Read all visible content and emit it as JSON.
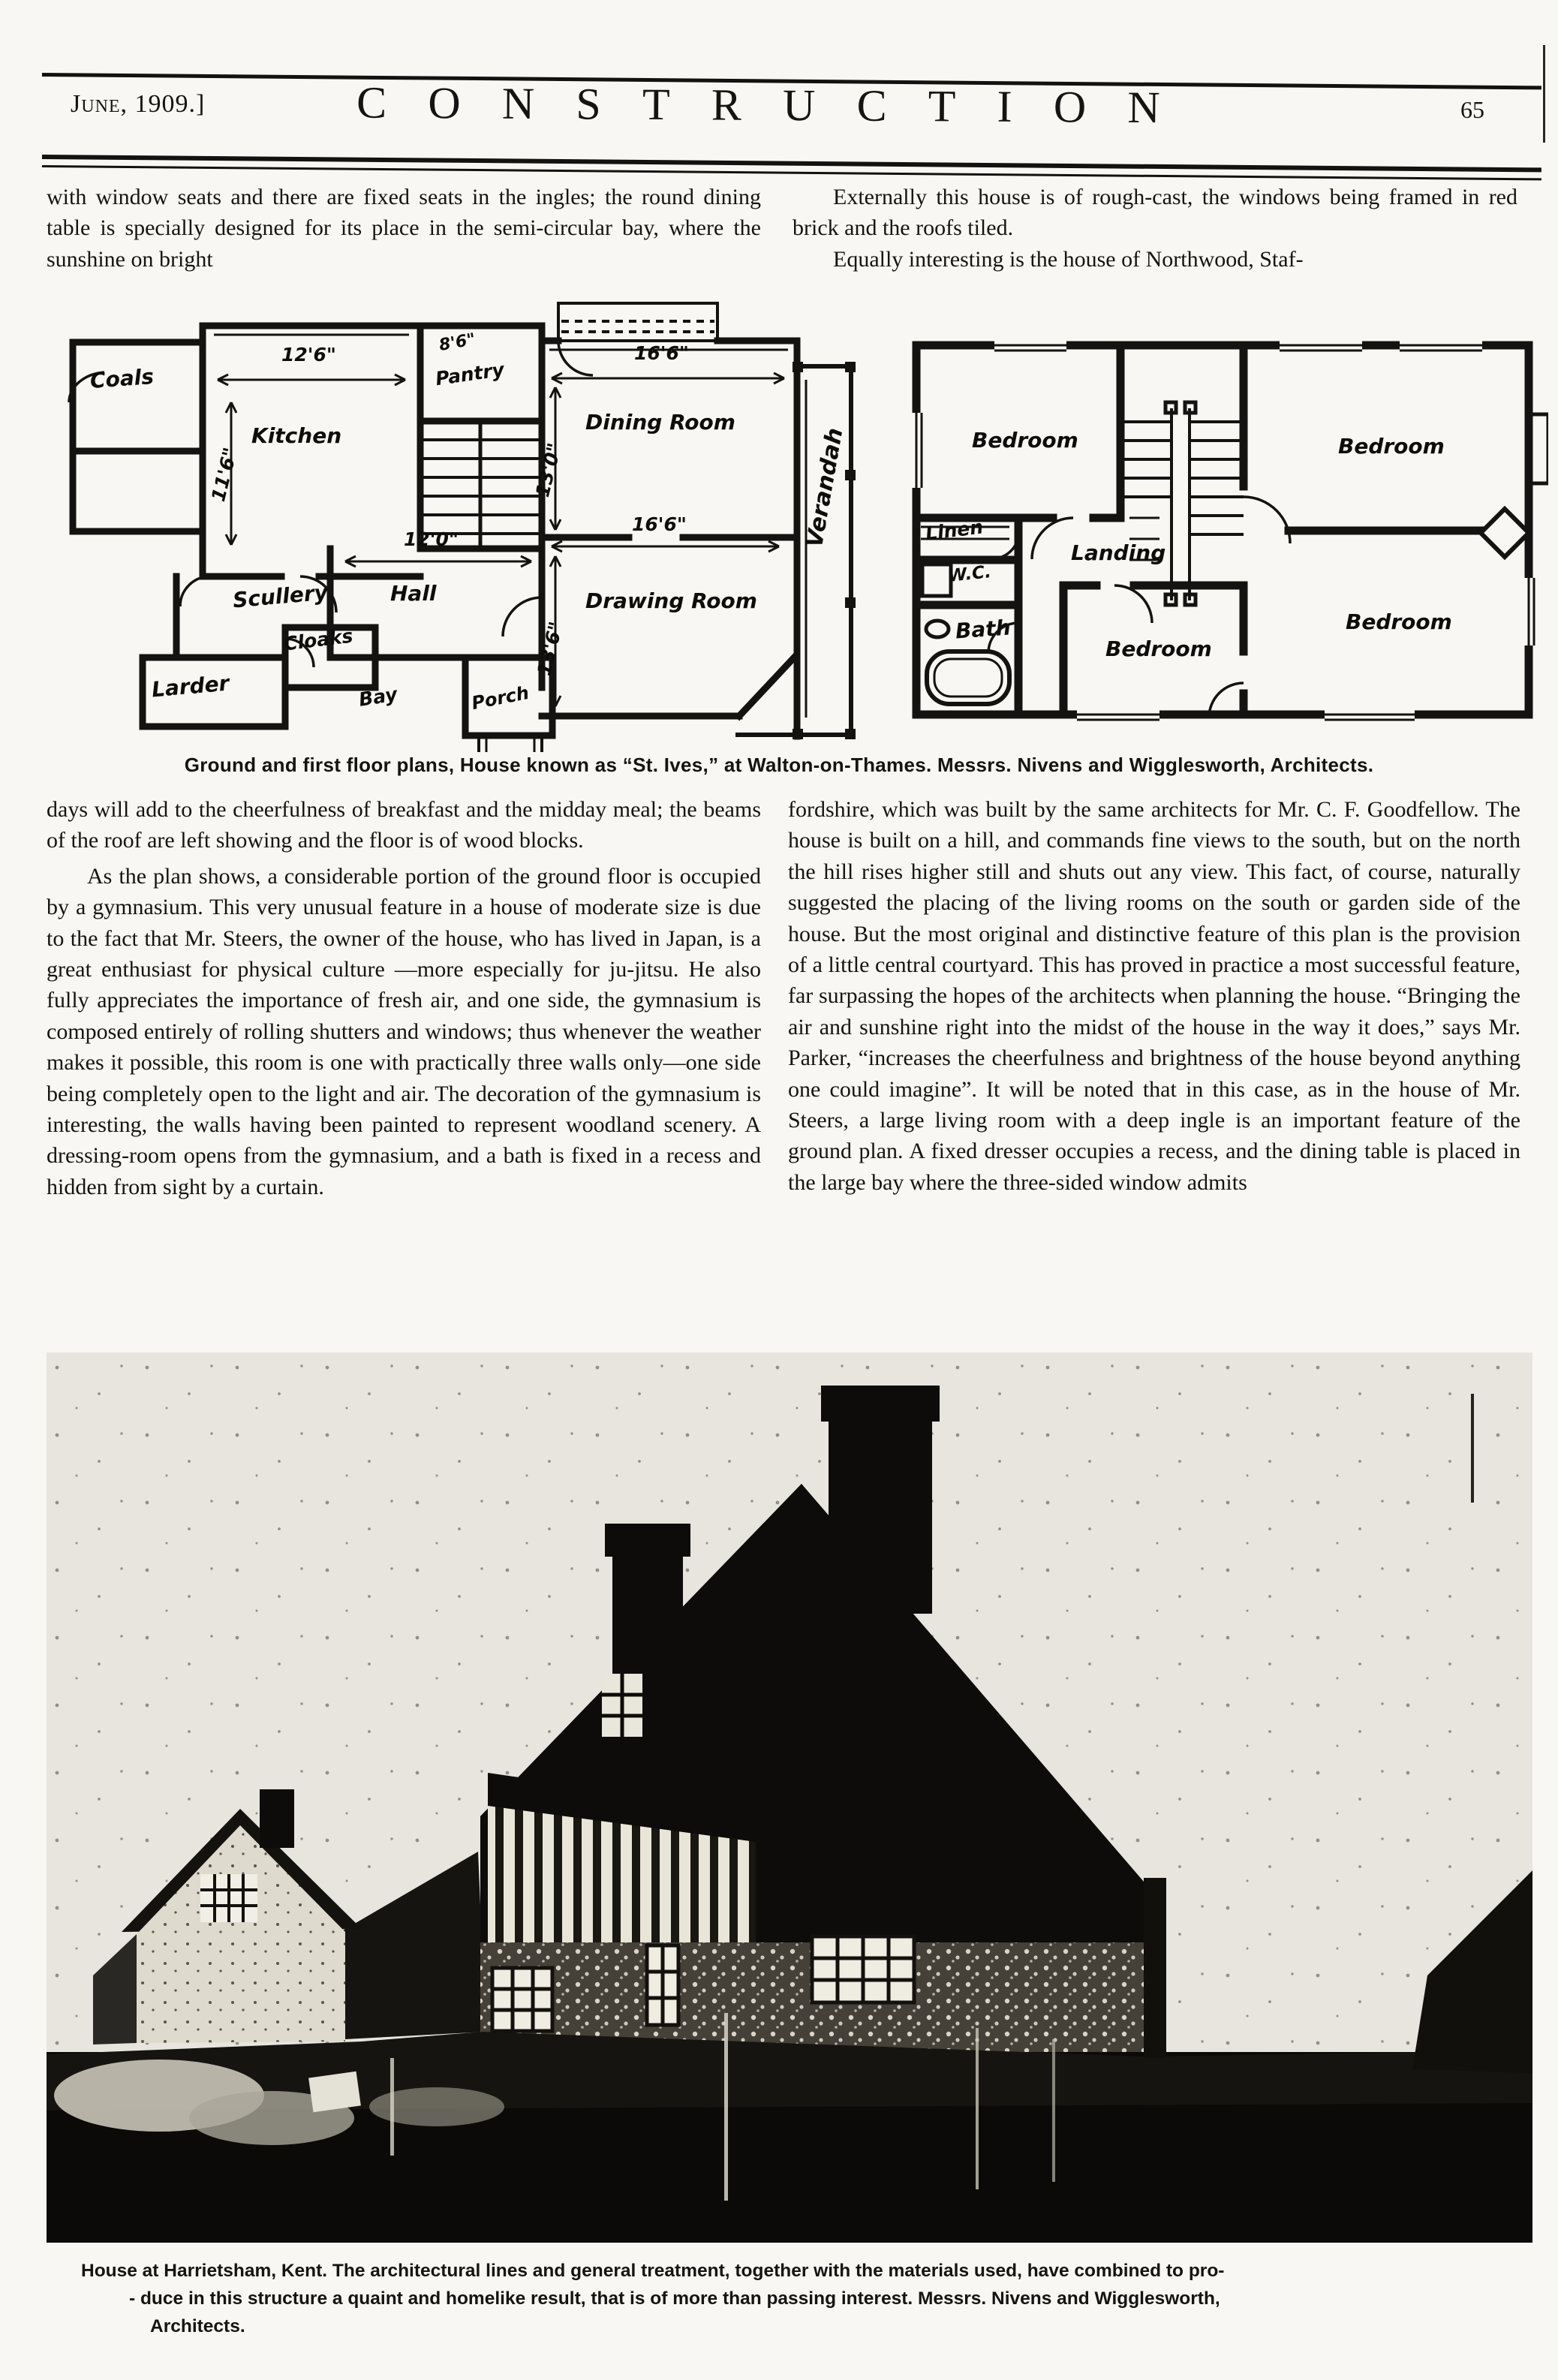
{
  "colors": {
    "ink": "#141413",
    "paper": "#f8f7f3",
    "photo_sky": "#e6e4dd",
    "photo_dark": "#0d0c0a"
  },
  "masthead": {
    "date": "June, 1909.]",
    "title": "CONSTRUCTION",
    "page_number": "65"
  },
  "intro": {
    "left": "with window seats and there are fixed seats in the ingles; the round dining table is specially designed for its place in the semi-circular bay, where the sunshine on bright",
    "right_para1": "Externally this house is of rough-cast, the windows being framed in red brick and the roofs tiled.",
    "right_para2": "Equally interesting is the house of Northwood, Staf-"
  },
  "plans": {
    "caption": "Ground and first floor plans, House known as “St. Ives,” at Walton-on-Thames.  Messrs. Nivens and Wigglesworth, Architects.",
    "ground": {
      "room_labels": [
        "Coals",
        "Kitchen",
        "Pantry",
        "Scullery",
        "Hall",
        "Larder",
        "Cloaks",
        "Bay",
        "Porch",
        "Dining Room",
        "Drawing Room",
        "Verandah"
      ],
      "dim_labels": [
        "12'6\"",
        "11'6\"",
        "8'6\"",
        "16'6\"",
        "13'0\"",
        "12'0\"",
        "16'6\"",
        "13'6\""
      ]
    },
    "first": {
      "room_labels": [
        "Bedroom",
        "Bedroom",
        "Linen",
        "Landing",
        "W.C.",
        "Bath",
        "Bedroom",
        "Bedroom"
      ]
    }
  },
  "article": {
    "left_para1": "days will add to the cheerfulness of breakfast and the midday meal; the beams of the roof are left showing and the floor is of wood blocks.",
    "left_para2": "As the plan shows, a considerable portion of the ground floor is occupied by a gymnasium.  This very unusual feature in a house of moderate size is due to the fact that Mr. Steers, the owner of the house, who has lived in Japan, is a great enthusiast for physical culture —more especially for ju-jitsu.  He also fully appreciates the importance of fresh air, and one side, the gymnasium is composed entirely of rolling shutters and windows; thus whenever the weather makes it possible, this room is one with practically three walls only—one side being completely open to the light and air.  The decoration of the gymnasium is interesting, the walls having been painted to represent woodland scenery.  A dressing-room opens from the gymnasium, and a bath is fixed in a recess and hidden from sight by a curtain.",
    "right_para1": "fordshire, which was built by the same architects for Mr. C. F. Goodfellow.  The house is built on a hill, and commands fine views to the south, but on the north the hill rises higher still and shuts out any view.  This fact, of course, naturally suggested the placing of the living rooms on the south or garden side of the house.  But the most original and distinctive feature of this plan is the provision of a little central courtyard.  This has proved in practice a most successful feature, far surpassing the hopes of the architects when planning the house.  “Bringing the air and sunshine right into the midst of the house in the way it does,” says Mr. Parker, “increases the cheerfulness and brightness of the house beyond anything one could imagine”.  It will be noted that in this case, as in the house of Mr. Steers, a large living room with a deep ingle is an important feature of the ground plan.  A fixed dresser occupies a recess, and the dining table is placed in the large bay where the three-sided window admits"
  },
  "photo_caption": {
    "line1": "House at Harrietsham, Kent.  The architectural lines and general treatment, together with the materials used, have combined to pro-",
    "line2": "- duce in this structure a quaint and homelike result, that is of more than passing interest.  Messrs. Nivens and Wigglesworth,",
    "line3": "Architects."
  }
}
